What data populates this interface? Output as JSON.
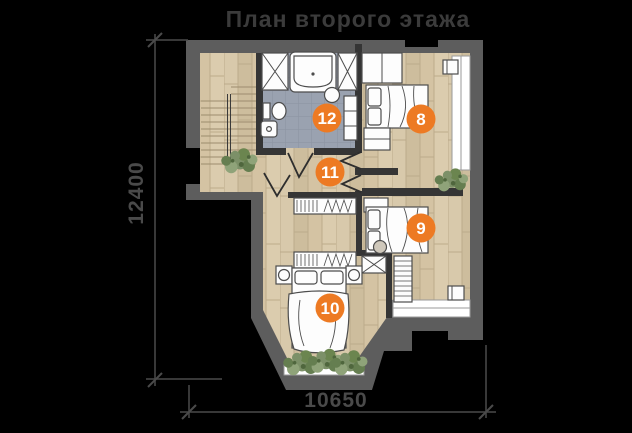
{
  "title": "План второго этажа",
  "dimensions": {
    "left": "12400",
    "bottom": "10650"
  },
  "rooms": {
    "r8": "8",
    "r9": "9",
    "r10": "10",
    "r11": "11",
    "r12": "12"
  },
  "colors": {
    "background": "#000000",
    "title_text": "#3b3b3b",
    "dimension": "#4a4a4a",
    "outer_wall": "#5d5d5d",
    "inner_wall": "#353535",
    "wood_floor": "#d5c5a6",
    "bath_tile": "#9aa2b0",
    "furniture_fill": "#fdfdfd",
    "badge_orange": "#ED7A23",
    "plant_green": "#7c9068",
    "window_white": "#ffffff"
  }
}
